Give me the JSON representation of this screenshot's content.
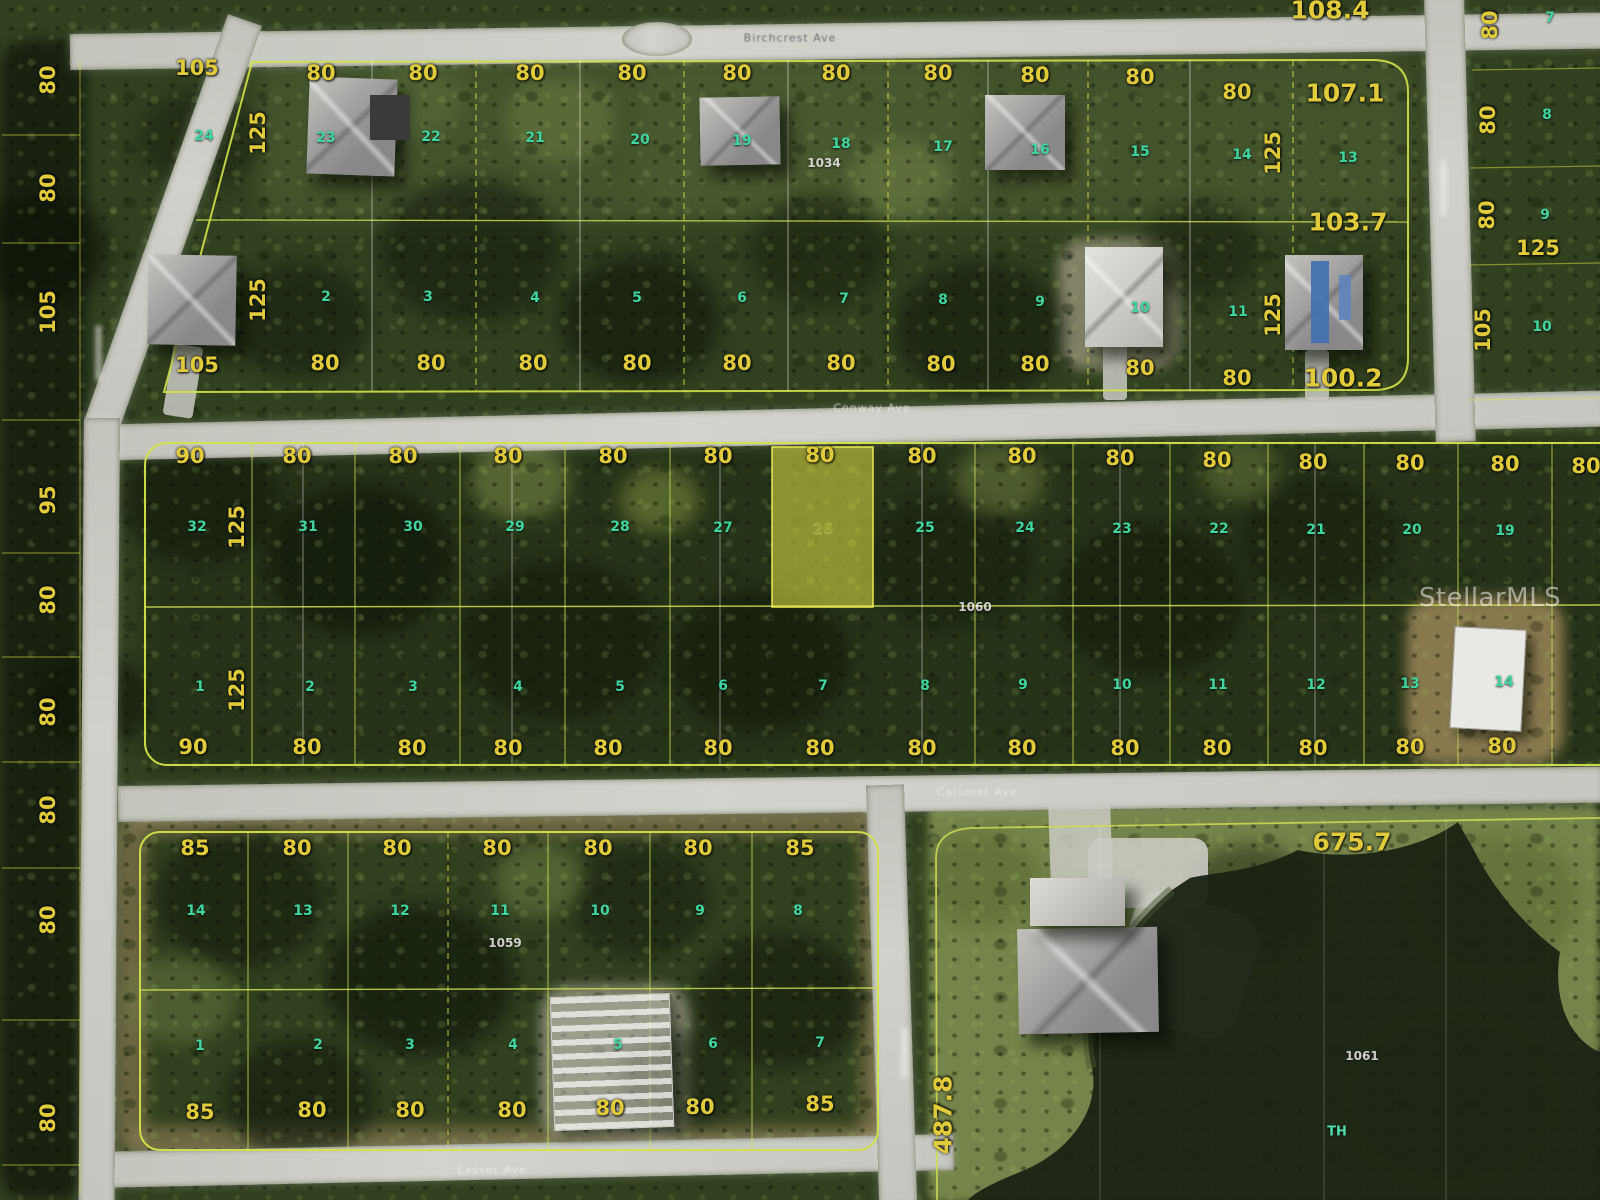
{
  "watermark": "StellarMLS",
  "subject_parcel": {
    "lot_number": "26",
    "frontage_label": "80",
    "block_number": "1060",
    "highlight_color": "#e8e846"
  },
  "block_numbers": [
    "1034",
    "1060",
    "1059",
    "1061"
  ],
  "streets": [
    "Birchcrest Ave",
    "Conway Ave",
    "Calumet Ave",
    "Lasser Ave"
  ],
  "terrain_note": "TH",
  "palette": {
    "dimension_text": "#e2cb3a",
    "lot_text": "#3fd6a2",
    "road": "#cfd0c8",
    "water": "#1a2213"
  },
  "labels": [
    {
      "t": "80",
      "x": 48,
      "y": 80,
      "r": 1,
      "c": "d"
    },
    {
      "t": "80",
      "x": 48,
      "y": 188,
      "r": 1,
      "c": "d"
    },
    {
      "t": "105",
      "x": 48,
      "y": 312,
      "r": 1,
      "c": "d"
    },
    {
      "t": "95",
      "x": 48,
      "y": 500,
      "r": 1,
      "c": "d"
    },
    {
      "t": "80",
      "x": 48,
      "y": 600,
      "r": 1,
      "c": "d"
    },
    {
      "t": "80",
      "x": 48,
      "y": 712,
      "r": 1,
      "c": "d"
    },
    {
      "t": "80",
      "x": 48,
      "y": 810,
      "r": 1,
      "c": "d"
    },
    {
      "t": "80",
      "x": 48,
      "y": 920,
      "r": 1,
      "c": "d"
    },
    {
      "t": "80",
      "x": 48,
      "y": 1118,
      "r": 1,
      "c": "d"
    },
    {
      "t": "105",
      "x": 197,
      "y": 68,
      "c": "d"
    },
    {
      "t": "125",
      "x": 258,
      "y": 133,
      "r": 1,
      "c": "d"
    },
    {
      "t": "24",
      "x": 204,
      "y": 136,
      "c": "l"
    },
    {
      "t": "105",
      "x": 197,
      "y": 365,
      "c": "d"
    },
    {
      "t": "125",
      "x": 258,
      "y": 300,
      "r": 1,
      "c": "d"
    },
    {
      "t": "80",
      "x": 321,
      "y": 73,
      "c": "d"
    },
    {
      "t": "80",
      "x": 423,
      "y": 73,
      "c": "d"
    },
    {
      "t": "80",
      "x": 530,
      "y": 73,
      "c": "d"
    },
    {
      "t": "80",
      "x": 632,
      "y": 73,
      "c": "d"
    },
    {
      "t": "80",
      "x": 737,
      "y": 73,
      "c": "d"
    },
    {
      "t": "80",
      "x": 836,
      "y": 73,
      "c": "d"
    },
    {
      "t": "80",
      "x": 938,
      "y": 73,
      "c": "d"
    },
    {
      "t": "80",
      "x": 1035,
      "y": 75,
      "c": "d"
    },
    {
      "t": "80",
      "x": 1140,
      "y": 77,
      "c": "d"
    },
    {
      "t": "80",
      "x": 1237,
      "y": 92,
      "c": "d"
    },
    {
      "t": "107.1",
      "x": 1345,
      "y": 93,
      "c": "D"
    },
    {
      "t": "108.4",
      "x": 1330,
      "y": 10,
      "c": "D"
    },
    {
      "t": "23",
      "x": 326,
      "y": 138,
      "c": "l"
    },
    {
      "t": "22",
      "x": 431,
      "y": 137,
      "c": "l"
    },
    {
      "t": "21",
      "x": 535,
      "y": 138,
      "c": "l"
    },
    {
      "t": "20",
      "x": 640,
      "y": 140,
      "c": "l"
    },
    {
      "t": "19",
      "x": 742,
      "y": 141,
      "c": "l"
    },
    {
      "t": "18",
      "x": 841,
      "y": 144,
      "c": "l"
    },
    {
      "t": "17",
      "x": 943,
      "y": 147,
      "c": "l"
    },
    {
      "t": "16",
      "x": 1040,
      "y": 150,
      "c": "l"
    },
    {
      "t": "15",
      "x": 1140,
      "y": 152,
      "c": "l"
    },
    {
      "t": "14",
      "x": 1242,
      "y": 155,
      "c": "l"
    },
    {
      "t": "13",
      "x": 1348,
      "y": 158,
      "c": "l"
    },
    {
      "t": "1034",
      "x": 824,
      "y": 163,
      "c": "b"
    },
    {
      "t": "125",
      "x": 1273,
      "y": 153,
      "r": 1,
      "c": "d"
    },
    {
      "t": "103.7",
      "x": 1348,
      "y": 222,
      "c": "D"
    },
    {
      "t": "125",
      "x": 1273,
      "y": 315,
      "r": 1,
      "c": "d"
    },
    {
      "t": "2",
      "x": 326,
      "y": 297,
      "c": "l"
    },
    {
      "t": "3",
      "x": 428,
      "y": 297,
      "c": "l"
    },
    {
      "t": "4",
      "x": 535,
      "y": 298,
      "c": "l"
    },
    {
      "t": "5",
      "x": 637,
      "y": 298,
      "c": "l"
    },
    {
      "t": "6",
      "x": 742,
      "y": 298,
      "c": "l"
    },
    {
      "t": "7",
      "x": 844,
      "y": 299,
      "c": "l"
    },
    {
      "t": "8",
      "x": 943,
      "y": 300,
      "c": "l"
    },
    {
      "t": "9",
      "x": 1040,
      "y": 302,
      "c": "l"
    },
    {
      "t": "10",
      "x": 1140,
      "y": 308,
      "c": "l"
    },
    {
      "t": "11",
      "x": 1238,
      "y": 312,
      "c": "l"
    },
    {
      "t": "80",
      "x": 325,
      "y": 363,
      "c": "d"
    },
    {
      "t": "80",
      "x": 431,
      "y": 363,
      "c": "d"
    },
    {
      "t": "80",
      "x": 533,
      "y": 363,
      "c": "d"
    },
    {
      "t": "80",
      "x": 637,
      "y": 363,
      "c": "d"
    },
    {
      "t": "80",
      "x": 737,
      "y": 363,
      "c": "d"
    },
    {
      "t": "80",
      "x": 841,
      "y": 363,
      "c": "d"
    },
    {
      "t": "80",
      "x": 941,
      "y": 364,
      "c": "d"
    },
    {
      "t": "80",
      "x": 1035,
      "y": 364,
      "c": "d"
    },
    {
      "t": "80",
      "x": 1140,
      "y": 368,
      "c": "d"
    },
    {
      "t": "80",
      "x": 1237,
      "y": 378,
      "c": "d"
    },
    {
      "t": "100.2",
      "x": 1343,
      "y": 378,
      "c": "D"
    },
    {
      "t": "80",
      "x": 1490,
      "y": 25,
      "r": 1,
      "c": "d"
    },
    {
      "t": "80",
      "x": 1488,
      "y": 120,
      "r": 1,
      "c": "d"
    },
    {
      "t": "80",
      "x": 1487,
      "y": 215,
      "r": 1,
      "c": "d"
    },
    {
      "t": "105",
      "x": 1483,
      "y": 330,
      "r": 1,
      "c": "d"
    },
    {
      "t": "125",
      "x": 1538,
      "y": 248,
      "c": "d"
    },
    {
      "t": "7",
      "x": 1550,
      "y": 18,
      "c": "l"
    },
    {
      "t": "8",
      "x": 1547,
      "y": 115,
      "c": "l"
    },
    {
      "t": "9",
      "x": 1545,
      "y": 215,
      "c": "l"
    },
    {
      "t": "10",
      "x": 1542,
      "y": 327,
      "c": "l"
    },
    {
      "t": "90",
      "x": 190,
      "y": 456,
      "c": "d"
    },
    {
      "t": "80",
      "x": 297,
      "y": 456,
      "c": "d"
    },
    {
      "t": "80",
      "x": 403,
      "y": 456,
      "c": "d"
    },
    {
      "t": "80",
      "x": 508,
      "y": 456,
      "c": "d"
    },
    {
      "t": "80",
      "x": 613,
      "y": 456,
      "c": "d"
    },
    {
      "t": "80",
      "x": 718,
      "y": 456,
      "c": "d"
    },
    {
      "t": "80",
      "x": 820,
      "y": 455,
      "c": "d"
    },
    {
      "t": "80",
      "x": 922,
      "y": 456,
      "c": "d"
    },
    {
      "t": "80",
      "x": 1022,
      "y": 456,
      "c": "d"
    },
    {
      "t": "80",
      "x": 1120,
      "y": 458,
      "c": "d"
    },
    {
      "t": "80",
      "x": 1217,
      "y": 460,
      "c": "d"
    },
    {
      "t": "80",
      "x": 1313,
      "y": 462,
      "c": "d"
    },
    {
      "t": "80",
      "x": 1410,
      "y": 463,
      "c": "d"
    },
    {
      "t": "80",
      "x": 1505,
      "y": 464,
      "c": "d"
    },
    {
      "t": "80",
      "x": 1586,
      "y": 466,
      "c": "d"
    },
    {
      "t": "32",
      "x": 197,
      "y": 527,
      "c": "l"
    },
    {
      "t": "31",
      "x": 308,
      "y": 527,
      "c": "l"
    },
    {
      "t": "30",
      "x": 413,
      "y": 527,
      "c": "l"
    },
    {
      "t": "29",
      "x": 515,
      "y": 527,
      "c": "l"
    },
    {
      "t": "28",
      "x": 620,
      "y": 527,
      "c": "l"
    },
    {
      "t": "27",
      "x": 723,
      "y": 528,
      "c": "l"
    },
    {
      "t": "26",
      "x": 823,
      "y": 528,
      "c": "lh"
    },
    {
      "t": "25",
      "x": 925,
      "y": 528,
      "c": "l"
    },
    {
      "t": "24",
      "x": 1025,
      "y": 528,
      "c": "l"
    },
    {
      "t": "23",
      "x": 1122,
      "y": 529,
      "c": "l"
    },
    {
      "t": "22",
      "x": 1219,
      "y": 529,
      "c": "l"
    },
    {
      "t": "21",
      "x": 1316,
      "y": 530,
      "c": "l"
    },
    {
      "t": "20",
      "x": 1412,
      "y": 530,
      "c": "l"
    },
    {
      "t": "19",
      "x": 1505,
      "y": 531,
      "c": "l"
    },
    {
      "t": "125",
      "x": 237,
      "y": 527,
      "r": 1,
      "c": "d"
    },
    {
      "t": "125",
      "x": 237,
      "y": 690,
      "r": 1,
      "c": "d"
    },
    {
      "t": "1060",
      "x": 975,
      "y": 607,
      "c": "b"
    },
    {
      "t": "1",
      "x": 200,
      "y": 687,
      "c": "l"
    },
    {
      "t": "2",
      "x": 310,
      "y": 687,
      "c": "l"
    },
    {
      "t": "3",
      "x": 413,
      "y": 687,
      "c": "l"
    },
    {
      "t": "4",
      "x": 518,
      "y": 687,
      "c": "l"
    },
    {
      "t": "5",
      "x": 620,
      "y": 687,
      "c": "l"
    },
    {
      "t": "6",
      "x": 723,
      "y": 686,
      "c": "l"
    },
    {
      "t": "7",
      "x": 823,
      "y": 686,
      "c": "l"
    },
    {
      "t": "8",
      "x": 925,
      "y": 686,
      "c": "l"
    },
    {
      "t": "9",
      "x": 1023,
      "y": 685,
      "c": "l"
    },
    {
      "t": "10",
      "x": 1122,
      "y": 685,
      "c": "l"
    },
    {
      "t": "11",
      "x": 1218,
      "y": 685,
      "c": "l"
    },
    {
      "t": "12",
      "x": 1316,
      "y": 685,
      "c": "l"
    },
    {
      "t": "13",
      "x": 1410,
      "y": 684,
      "c": "l"
    },
    {
      "t": "14",
      "x": 1504,
      "y": 682,
      "c": "l"
    },
    {
      "t": "90",
      "x": 193,
      "y": 747,
      "c": "d"
    },
    {
      "t": "80",
      "x": 307,
      "y": 747,
      "c": "d"
    },
    {
      "t": "80",
      "x": 412,
      "y": 748,
      "c": "d"
    },
    {
      "t": "80",
      "x": 508,
      "y": 748,
      "c": "d"
    },
    {
      "t": "80",
      "x": 608,
      "y": 748,
      "c": "d"
    },
    {
      "t": "80",
      "x": 718,
      "y": 748,
      "c": "d"
    },
    {
      "t": "80",
      "x": 820,
      "y": 748,
      "c": "d"
    },
    {
      "t": "80",
      "x": 922,
      "y": 748,
      "c": "d"
    },
    {
      "t": "80",
      "x": 1022,
      "y": 748,
      "c": "d"
    },
    {
      "t": "80",
      "x": 1125,
      "y": 748,
      "c": "d"
    },
    {
      "t": "80",
      "x": 1217,
      "y": 748,
      "c": "d"
    },
    {
      "t": "80",
      "x": 1313,
      "y": 748,
      "c": "d"
    },
    {
      "t": "80",
      "x": 1410,
      "y": 747,
      "c": "d"
    },
    {
      "t": "80",
      "x": 1502,
      "y": 746,
      "c": "d"
    },
    {
      "t": "85",
      "x": 195,
      "y": 848,
      "c": "d"
    },
    {
      "t": "80",
      "x": 297,
      "y": 848,
      "c": "d"
    },
    {
      "t": "80",
      "x": 397,
      "y": 848,
      "c": "d"
    },
    {
      "t": "80",
      "x": 497,
      "y": 848,
      "c": "d"
    },
    {
      "t": "80",
      "x": 598,
      "y": 848,
      "c": "d"
    },
    {
      "t": "80",
      "x": 698,
      "y": 848,
      "c": "d"
    },
    {
      "t": "85",
      "x": 800,
      "y": 848,
      "c": "d"
    },
    {
      "t": "14",
      "x": 196,
      "y": 911,
      "c": "l"
    },
    {
      "t": "13",
      "x": 303,
      "y": 911,
      "c": "l"
    },
    {
      "t": "12",
      "x": 400,
      "y": 911,
      "c": "l"
    },
    {
      "t": "11",
      "x": 500,
      "y": 911,
      "c": "l"
    },
    {
      "t": "10",
      "x": 600,
      "y": 911,
      "c": "l"
    },
    {
      "t": "9",
      "x": 700,
      "y": 911,
      "c": "l"
    },
    {
      "t": "8",
      "x": 798,
      "y": 911,
      "c": "l"
    },
    {
      "t": "1059",
      "x": 505,
      "y": 943,
      "c": "b"
    },
    {
      "t": "1",
      "x": 200,
      "y": 1046,
      "c": "l"
    },
    {
      "t": "2",
      "x": 318,
      "y": 1045,
      "c": "l"
    },
    {
      "t": "3",
      "x": 410,
      "y": 1045,
      "c": "l"
    },
    {
      "t": "4",
      "x": 513,
      "y": 1045,
      "c": "l"
    },
    {
      "t": "5",
      "x": 618,
      "y": 1045,
      "c": "l"
    },
    {
      "t": "6",
      "x": 713,
      "y": 1044,
      "c": "l"
    },
    {
      "t": "7",
      "x": 820,
      "y": 1043,
      "c": "l"
    },
    {
      "t": "85",
      "x": 200,
      "y": 1112,
      "c": "d"
    },
    {
      "t": "80",
      "x": 312,
      "y": 1110,
      "c": "d"
    },
    {
      "t": "80",
      "x": 410,
      "y": 1110,
      "c": "d"
    },
    {
      "t": "80",
      "x": 512,
      "y": 1110,
      "c": "d"
    },
    {
      "t": "80",
      "x": 610,
      "y": 1108,
      "c": "d"
    },
    {
      "t": "80",
      "x": 700,
      "y": 1107,
      "c": "d"
    },
    {
      "t": "85",
      "x": 820,
      "y": 1104,
      "c": "d"
    },
    {
      "t": "675.7",
      "x": 1352,
      "y": 842,
      "c": "D"
    },
    {
      "t": "487.8",
      "x": 943,
      "y": 1115,
      "r": 1,
      "c": "D"
    },
    {
      "t": "1061",
      "x": 1362,
      "y": 1056,
      "c": "b"
    },
    {
      "t": "TH",
      "x": 1337,
      "y": 1132,
      "c": "t"
    },
    {
      "t": "Birchcrest Ave",
      "x": 790,
      "y": 38,
      "c": "sd"
    },
    {
      "t": "Conway Ave",
      "x": 872,
      "y": 408,
      "c": "s"
    },
    {
      "t": "Calumet Ave",
      "x": 977,
      "y": 792,
      "c": "s"
    },
    {
      "t": "Lasser Ave",
      "x": 492,
      "y": 1170,
      "c": "s"
    }
  ]
}
